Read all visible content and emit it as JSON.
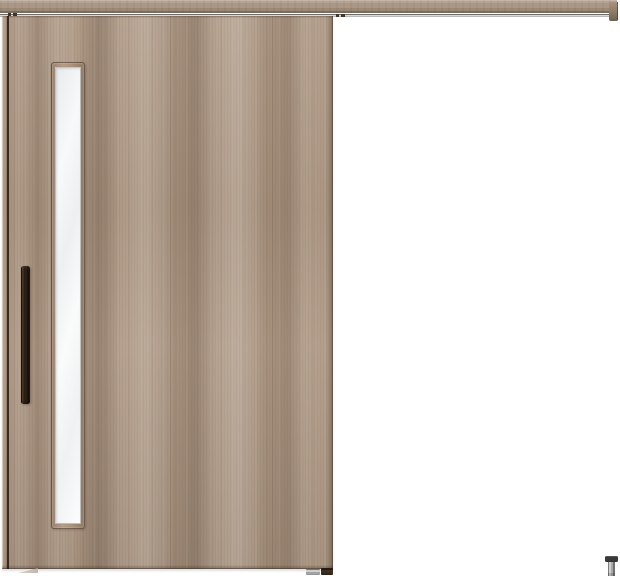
{
  "scene": {
    "width": 620,
    "height": 576,
    "subject": "wood-grain outset sliding door with top rail, vertical slit window, bar handle and floor guide"
  },
  "colors": {
    "bg": "#ffffff",
    "wood_base": "#ad9782",
    "wood_light": "#c4ae98",
    "wood_dark": "#8f7a66",
    "wood_edge_seam": "#3a2a20",
    "rail_face": "#ab9884",
    "track_gray": "#dadada",
    "handle_dark": "#2a1e16",
    "glass_light": "#f7f9fa",
    "glass_shade": "#e8ebec",
    "guide_cap": "#3b3937",
    "guide_body": "#a8a8a8"
  },
  "parts": {
    "rail": "top-hanging-rail",
    "rail_track": "rail-track-groove",
    "rail_endcap": "rail-end-cap",
    "door": "sliding-door-panel",
    "window": "vertical-slit-window",
    "glass": "frosted-glass-pane",
    "handle": "vertical-bar-pull-handle",
    "bottom_guide_metal": "bottom-guide-metal",
    "bottom_guide_dark": "bottom-guide-dark",
    "floor_guide": "floor-guide-pin"
  }
}
